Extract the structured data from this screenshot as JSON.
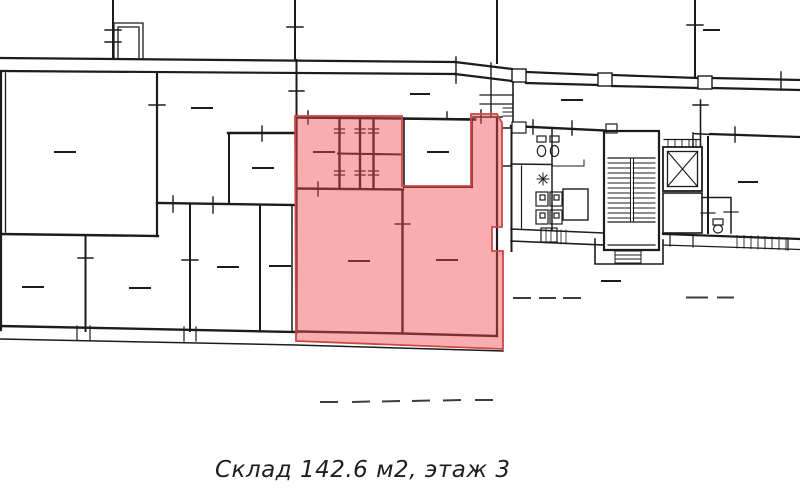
{
  "caption": {
    "text": "Склад 142.6 м2, этаж 3"
  },
  "highlight": {
    "name": "selected-unit-warehouse",
    "fill": "rgba(240,75,75,0.45)",
    "border": "#cc4747"
  },
  "plan": {
    "wall_color": "#1c1c1c",
    "dash_color": "#3d3d3d",
    "features": [
      "staircase-icon",
      "elevator-icon",
      "toilet-icon",
      "washbasin-icon",
      "entrance-porch",
      "window-hatch",
      "room-label-dash"
    ]
  }
}
